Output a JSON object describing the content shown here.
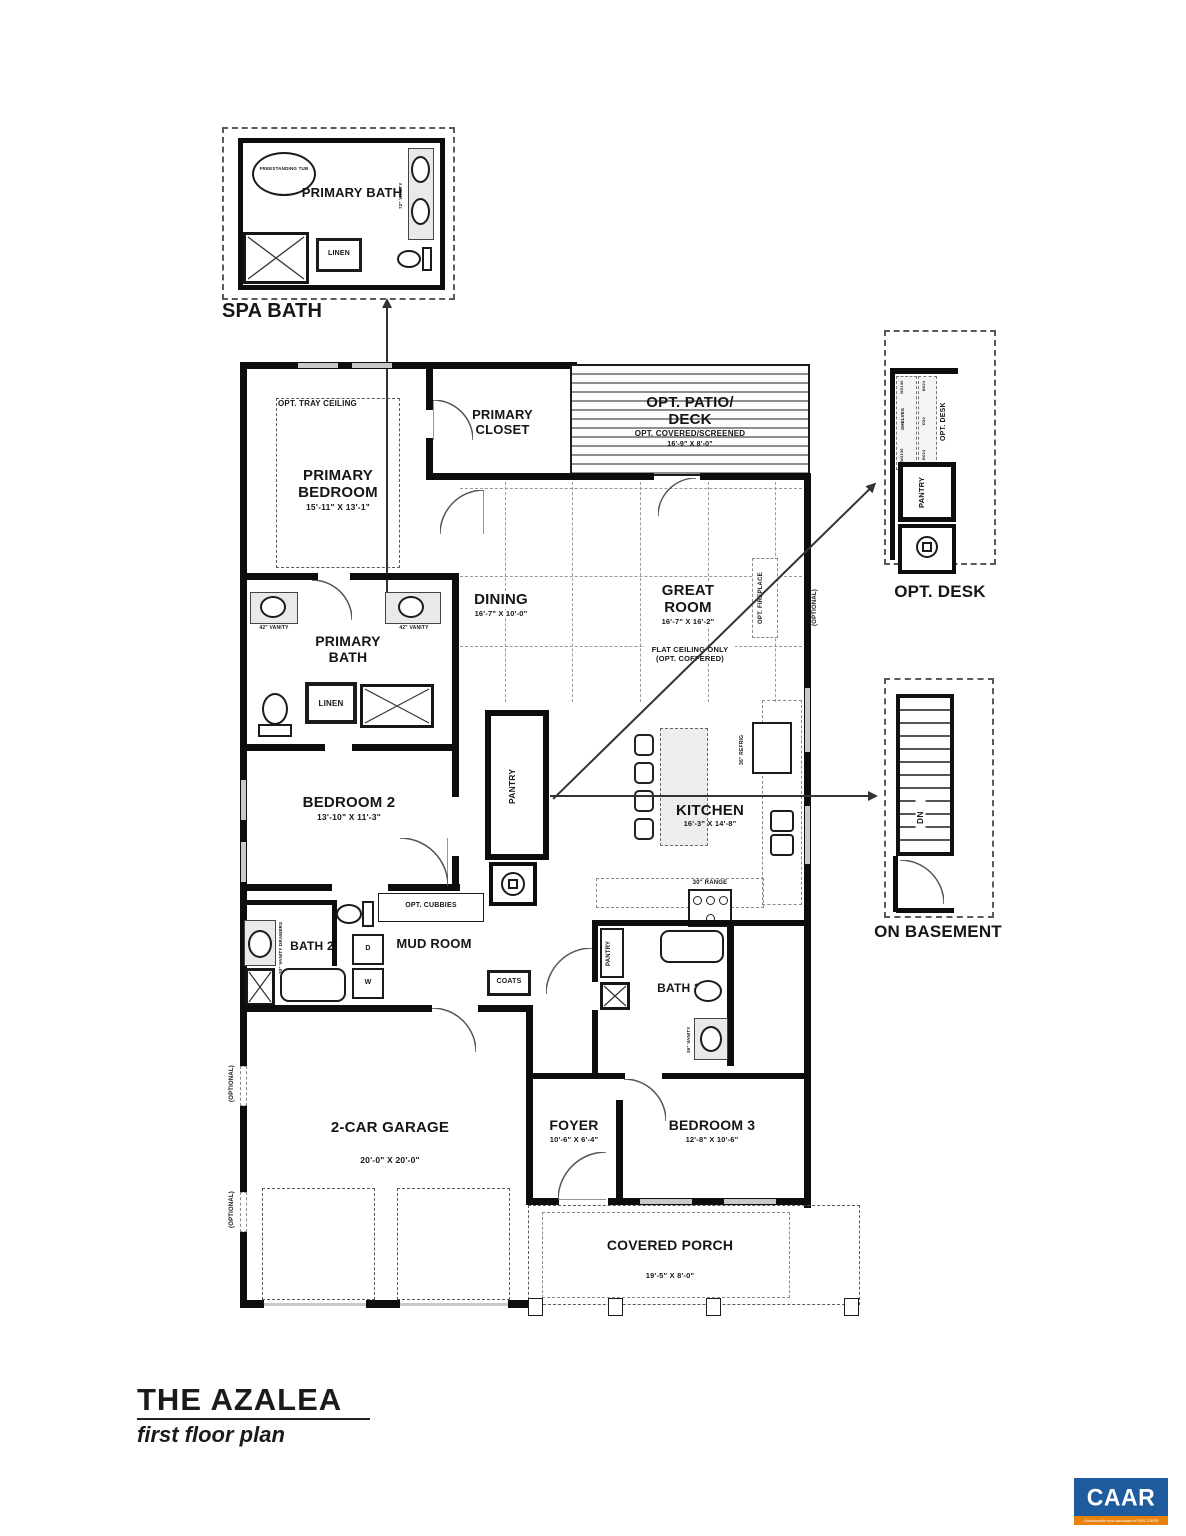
{
  "page": {
    "title": "THE AZALEA",
    "subtitle": "first floor plan"
  },
  "details": {
    "spa_bath": {
      "title": "SPA BATH",
      "room": "PRIMARY BATH",
      "tub": "FREESTANDING TUB",
      "linen": "LINEN",
      "vanity": "72\" VANITY"
    },
    "opt_desk": {
      "title": "OPT. DESK",
      "desk_v": "OPT. DESK",
      "pantry": "PANTRY",
      "shelves": "SHELVES",
      "w1": "W2130",
      "w2": "W2130",
      "b1": "B021",
      "d": "D30",
      "b2": "B021"
    },
    "on_basement": {
      "title": "ON BASEMENT",
      "dn": "DN"
    }
  },
  "rooms": {
    "primary_bedroom": {
      "name": "PRIMARY BEDROOM",
      "dims": "15'-11\" X 13'-1\"",
      "tray": "OPT. TRAY CEILING"
    },
    "primary_closet": {
      "name": "PRIMARY CLOSET"
    },
    "patio": {
      "name1": "OPT. PATIO/",
      "name2": "DECK",
      "note": "OPT. COVERED/SCREENED",
      "dims": "16'-9\" X 8'-0\""
    },
    "dining": {
      "name": "DINING",
      "dims": "16'-7\" X 10'-0\""
    },
    "great_room": {
      "name": "GREAT ROOM",
      "dims": "16'-7\" X 16'-2\"",
      "note1": "FLAT CEILING ONLY",
      "note2": "(OPT. COFFERED)",
      "fireplace": "OPT. FIREPLACE"
    },
    "primary_bath": {
      "name": "PRIMARY BATH",
      "linen": "LINEN"
    },
    "bedroom2": {
      "name": "BEDROOM 2",
      "dims": "13'-10\" X 11'-3\""
    },
    "pantry": {
      "name": "PANTRY"
    },
    "kitchen": {
      "name": "KITCHEN",
      "dims": "16'-3\" X 14'-8\"",
      "refrig": "36\" REFRIG",
      "range": "30\" RANGE"
    },
    "bath2": {
      "name": "BATH 2",
      "vanity": "30\" VANITY DRAWERS"
    },
    "mud_room": {
      "name": "MUD ROOM",
      "cubbies": "OPT. CUBBIES",
      "coats": "COATS"
    },
    "bath3": {
      "name": "BATH 3",
      "pantry": "PANTRY",
      "vanity": "36\" VANITY"
    },
    "garage": {
      "name": "2-CAR GARAGE",
      "dims": "20'-0\" X 20'-0\""
    },
    "foyer": {
      "name": "FOYER",
      "dims": "10'-6\" X 6'-4\""
    },
    "bedroom3": {
      "name": "BEDROOM 3",
      "dims": "12'-8\" X 10'-6\""
    },
    "porch": {
      "name": "COVERED PORCH",
      "dims": "19'-5\" X 8'-0\""
    }
  },
  "misc": {
    "optional": "(OPTIONAL)",
    "vanity42": "42\" VANITY",
    "washer": "W",
    "dryer": "D"
  },
  "logo": {
    "text": "CAAR",
    "tagline": "Charlottesville Area Association of REALTORS®",
    "blue": "#1e5c9e",
    "orange": "#e8820c"
  }
}
